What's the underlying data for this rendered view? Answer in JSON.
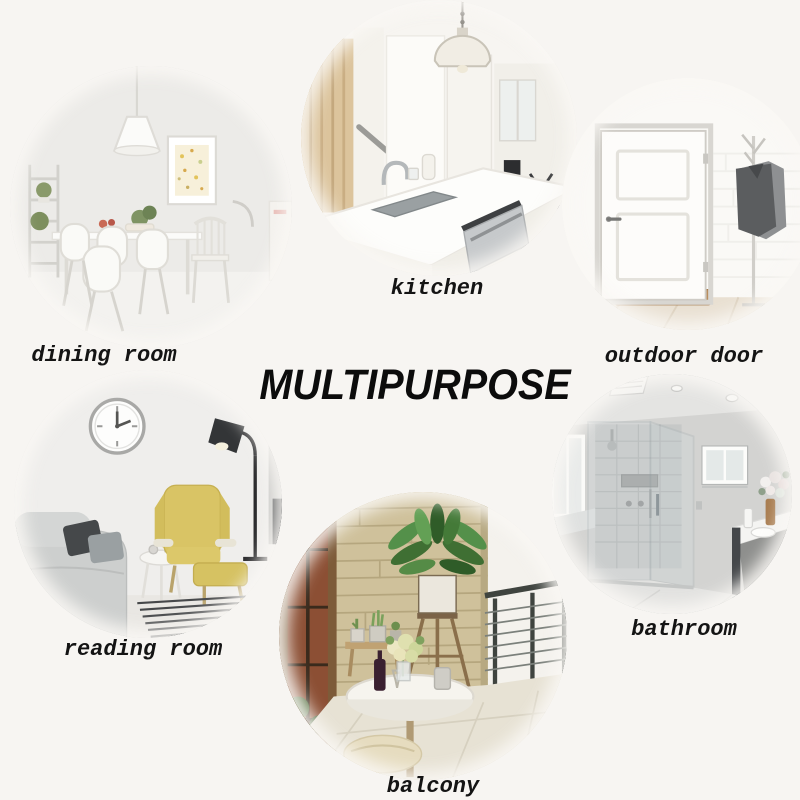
{
  "page": {
    "background_color": "#f7f5f2"
  },
  "title": {
    "text": "MULTIPURPOSE",
    "color": "#0c0c0c"
  },
  "sections": [
    {
      "id": "dining-room",
      "label": "dining room",
      "alt": "white dining table with white chairs, pendant lamp, framed art and ladder shelf"
    },
    {
      "id": "kitchen",
      "label": "kitchen",
      "alt": "white kitchen island with sink, faucet, pendant dome lamp and wooden stair"
    },
    {
      "id": "outdoor-door",
      "label": "outdoor door",
      "alt": "white panel door with coat rack and doormat"
    },
    {
      "id": "reading-room",
      "label": "reading room",
      "alt": "yellow wingback chair, grey sofa, wall clock, black floor lamp and side table"
    },
    {
      "id": "balcony",
      "label": "balcony",
      "alt": "stone wall balcony with plant stand, potted cacti, round white table and railing"
    },
    {
      "id": "bathroom",
      "label": "bathroom",
      "alt": "glass shower enclosure, window, vanity with flowers"
    }
  ],
  "palette": {
    "label_color": "#141414",
    "chair_yellow": "#d9c465",
    "plant_green": "#4c7a3d",
    "stone_wall": "#cfc19b",
    "coat_gray": "#5b5d5f",
    "bath_gray": "#d3d3d1",
    "wood_brown": "#b98f5f"
  }
}
